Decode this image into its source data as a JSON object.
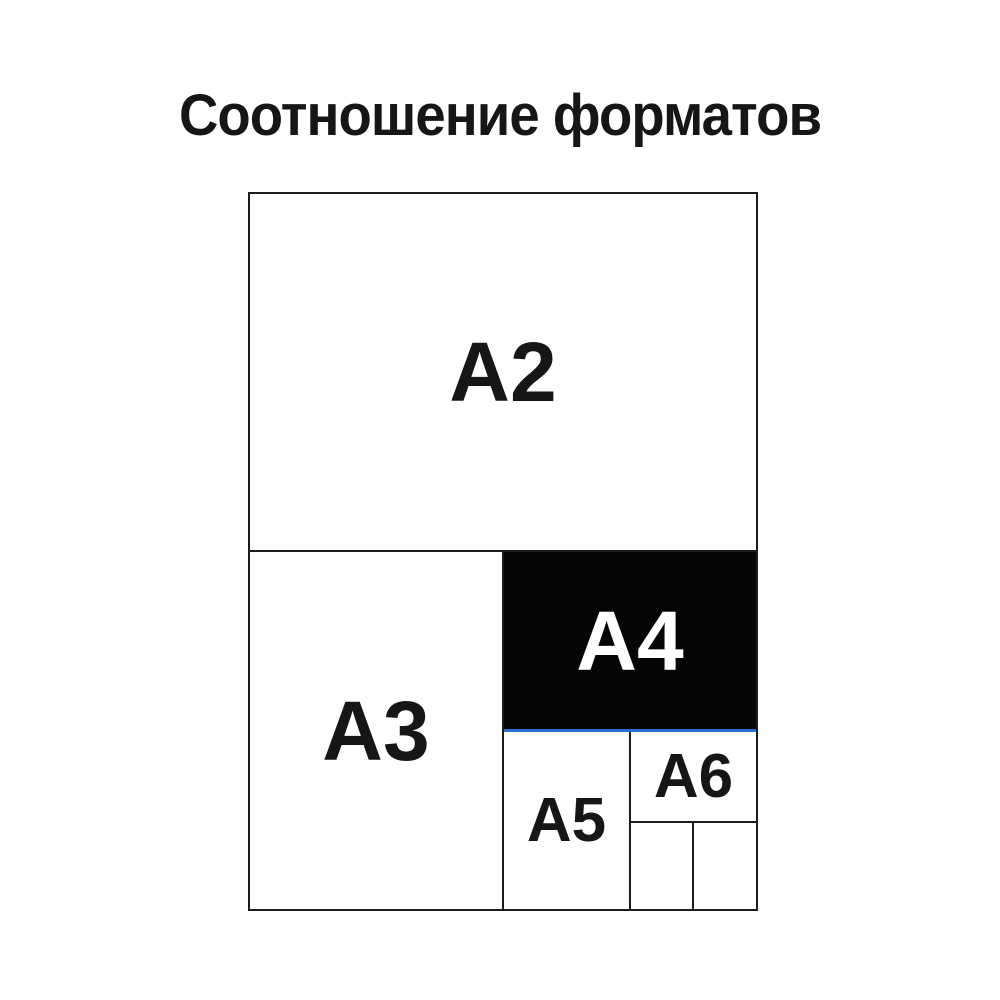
{
  "page": {
    "title": "Соотношение форматов"
  },
  "colors": {
    "background": "#ffffff",
    "title_text": "#161616",
    "line": "#1c1c1c",
    "label_text": "#161616",
    "a4_fill": "#050505",
    "a4_label_text": "#ffffff",
    "a4_underline": "#2a6fd2"
  },
  "diagram": {
    "formats": {
      "a2": "А2",
      "a3": "А3",
      "a4": "А4",
      "a5": "А5",
      "a6": "А6"
    }
  }
}
